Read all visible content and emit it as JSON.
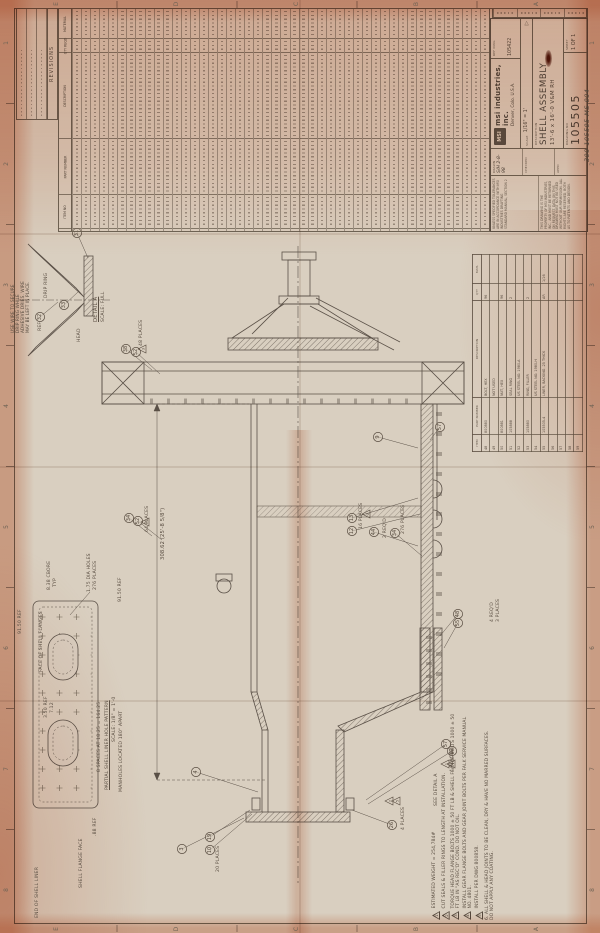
{
  "title_block": {
    "logo": "MSI",
    "company": "msi industries, inc.",
    "company_location": "Denver, Colo. U.S.A.",
    "ref_dwg_label": "REF DWG",
    "ref_dwg": "105422",
    "scale_label": "SCALE",
    "scale": "1/16\" = 1'",
    "description_label": "DESCRIPTION",
    "description_line1": "SHELL ASSEMBLY",
    "description_line2": "13'-6 x 16'-0 V&M RH",
    "drawing_no_label": "DRAWING NO",
    "drawing_no": "105505",
    "sheet_label": "SHEET",
    "sheet": "1 OF 1",
    "drawn_label": "DRAWN",
    "drawn": "S/H 2-8-98",
    "checked_label": "CHECKED",
    "appd_label": "APPD",
    "projection_symbol": "▷",
    "tolerance_note": "UNLESS SPECIFIED TOLERANCES ARE IN ACCORDANCE WITH MSI INDUSTRIES DRAFTING STANDARD MANUAL, SECTION 2",
    "property_note": "THIS DRAWING IS THE PROPERTY OF MSI INDUSTRIES, INC., AND MUST BE RETURNED ON REQUEST. DATA ON THIS DRAWING MUST NOT BE USED WITHOUT OUR PERMISSION. ALL RIGHTS ARE RESERVED, BOTH AS TO PATENTS AND DESIGN."
  },
  "handwritten_number": "300-105505-MS-004",
  "revisions_block": {
    "title": "REVISIONS"
  },
  "parts_table": {
    "headers": [
      "MATERIAL",
      "QTY REQD",
      "DESCRIPTION",
      "PART NUMBER",
      "ITEM NO"
    ],
    "band_heights": [
      30,
      14,
      86,
      56,
      34
    ],
    "column_count": 46
  },
  "mid_parts_table": {
    "headers": [
      "ITEM",
      "PART NUMBER",
      "DESCRIPTION",
      "QTY",
      "MATL"
    ],
    "col_widths": [
      14,
      34,
      94,
      14,
      26
    ],
    "rows": [
      [
        "48",
        "800880",
        "BOLT, HEX",
        "96",
        ""
      ],
      [
        "49",
        "",
        "NOT USED",
        "",
        ""
      ],
      [
        "50",
        "800881",
        "NUT, HEX",
        "96",
        ""
      ],
      [
        "51",
        "105888",
        "SEAL RING",
        "2",
        ""
      ],
      [
        "52",
        "",
        "US STEEL NO. 1980-A",
        "",
        ""
      ],
      [
        "53",
        "105880",
        "RING, FILLER",
        "2",
        ""
      ],
      [
        "54",
        "",
        "US STEEL NO. 1980-H",
        "",
        ""
      ],
      [
        "55",
        "105505-4",
        "LINER, BACKING .25 THICK",
        "AR",
        "1/16"
      ],
      [
        "56",
        "",
        "",
        "",
        ""
      ],
      [
        "57",
        "",
        "",
        "",
        ""
      ],
      [
        "58",
        "",
        "",
        "",
        ""
      ],
      [
        "59",
        "",
        "",
        "",
        ""
      ]
    ]
  },
  "notes": [
    {
      "flag": "1",
      "text": "ESTIMATED WEIGHT = 254,784#"
    },
    {
      "flag": "2",
      "text": "CUT SEALS & FILLER RINGS TO LENGTH AT INSTALLATION."
    },
    {
      "flag": "3",
      "text": "TORQUE HEAD FLANGE BOLTS 1000 ± 50 FT LB & SHELL FLANGE BOLTS 1000 ± 50 FT LB IN \"AS REC'D\" COND. DO NOT OIL."
    },
    {
      "flag": "4",
      "text": "INSTALL GEAR FLANGE BOLTS AND GEAR JOINT BOLTS PER FALK SERVICE MANUAL NO. 4801."
    },
    {
      "flag": "5",
      "text": "INSTALL PER DWG 800858."
    },
    {
      "flag": "",
      "prefix": "6.  ",
      "text": "ALL SHELL & HEAD JOINTS TO BE CLEAN, DRY & HAVE NO MARRED SURFACES. DO NOT APPLY ANY COATING."
    }
  ],
  "drawing_labels": [
    {
      "x": 10,
      "y": 333,
      "t": "USE WIRE TO SECURE",
      "s": 4.2
    },
    {
      "x": 15,
      "y": 333,
      "t": "DRIP RING WHILE",
      "s": 4.2
    },
    {
      "x": 20,
      "y": 333,
      "t": "ADHESIVE DRIES. WIRE",
      "s": 4.2
    },
    {
      "x": 25,
      "y": 333,
      "t": "MAY BE LEFT IN PLACE.",
      "s": 4.2
    },
    {
      "x": 44,
      "y": 298,
      "t": "DRIP RING"
    },
    {
      "x": 38,
      "y": 331,
      "t": "REF"
    },
    {
      "x": 77,
      "y": 342,
      "t": "HEAD"
    },
    {
      "x": 93,
      "y": 322,
      "t": "DETAIL A",
      "s": 5.4,
      "u": true
    },
    {
      "x": 101,
      "y": 322,
      "t": "SCALE: FULL"
    },
    {
      "x": 139,
      "y": 346,
      "t": "48 PLACES"
    },
    {
      "x": 145,
      "y": 532,
      "t": "64 PLACES"
    },
    {
      "x": 160,
      "y": 560,
      "t": "308.62 (25'-8 5/8\")",
      "s": 5.2
    },
    {
      "x": 359,
      "y": 529,
      "t": "16 PLACES"
    },
    {
      "x": 383,
      "y": 538,
      "t": "2 REQ'D"
    },
    {
      "x": 401,
      "y": 534,
      "t": "276 PLACES"
    },
    {
      "x": 18,
      "y": 634,
      "t": "91.50 REF"
    },
    {
      "x": 118,
      "y": 602,
      "t": "91.50 REF"
    },
    {
      "x": 47,
      "y": 590,
      "t": "8.38 CBORE"
    },
    {
      "x": 53,
      "y": 587,
      "t": "TYP"
    },
    {
      "x": 87,
      "y": 592,
      "t": "1.75 DIA HOLES"
    },
    {
      "x": 93,
      "y": 590,
      "t": "276 PLACES"
    },
    {
      "x": 39,
      "y": 672,
      "t": "FACE OF SHELL FLANGES"
    },
    {
      "x": 44,
      "y": 718,
      "t": "3.50 REF"
    },
    {
      "x": 50,
      "y": 713,
      "t": "7.12"
    },
    {
      "x": 97,
      "y": 772,
      "t": "8 SPACES AT 18.25 = 164.25"
    },
    {
      "x": 105,
      "y": 790,
      "t": "PARTIAL SHELL LINER HOLE PATTERN",
      "u": true
    },
    {
      "x": 112,
      "y": 742,
      "t": "SCALE: 1/8\" = 1'-0"
    },
    {
      "x": 119,
      "y": 792,
      "t": "MANHOLES LOCATED 180° APART"
    },
    {
      "x": 93,
      "y": 836,
      "t": ".88 REF"
    },
    {
      "x": 35,
      "y": 918,
      "t": "END OF SHELL LINER"
    },
    {
      "x": 79,
      "y": 888,
      "t": "SHELL FLANGE FACE"
    },
    {
      "x": 434,
      "y": 806,
      "t": "SEE DETAIL A"
    },
    {
      "x": 450,
      "y": 772,
      "t": "4 PLACES"
    },
    {
      "x": 490,
      "y": 622,
      "t": "4 REQ'D"
    },
    {
      "x": 496,
      "y": 622,
      "t": "3 PLACES"
    },
    {
      "x": 216,
      "y": 872,
      "t": "20 PLACES"
    },
    {
      "x": 401,
      "y": 830,
      "t": "4 PLACES"
    },
    {
      "x": 583,
      "y": 162,
      "t": "300-105505-MS-004",
      "s": 6.5,
      "hw": true
    }
  ],
  "balloons": [
    {
      "n": "31",
      "x": 77,
      "y": 233,
      "tx": 88,
      "ty": 258
    },
    {
      "n": "32",
      "x": 40,
      "y": 317,
      "tx": 58,
      "ty": 302
    },
    {
      "n": "33",
      "x": 64,
      "y": 305,
      "tx": 78,
      "ty": 292
    },
    {
      "n": "38",
      "x": 126,
      "y": 349,
      "tx": 152,
      "ty": 370
    },
    {
      "n": "52",
      "x": 136,
      "y": 352,
      "tx": 160,
      "ty": 374
    },
    {
      "n": "34",
      "x": 129,
      "y": 518,
      "tx": 152,
      "ty": 536
    },
    {
      "n": "52",
      "x": 138,
      "y": 521,
      "tx": 162,
      "ty": 540
    },
    {
      "n": "13",
      "x": 352,
      "y": 518,
      "tx": 418,
      "ty": 498
    },
    {
      "n": "12",
      "x": 352,
      "y": 531,
      "tx": 420,
      "ty": 514
    },
    {
      "n": "44",
      "x": 374,
      "y": 532,
      "tx": 418,
      "ty": 546
    },
    {
      "n": "34",
      "x": 395,
      "y": 533,
      "tx": 422,
      "ty": 556
    },
    {
      "n": "9",
      "x": 378,
      "y": 437,
      "tx": 418,
      "ty": 448
    },
    {
      "n": "57",
      "x": 440,
      "y": 427,
      "tx": 430,
      "ty": 440
    },
    {
      "n": "48",
      "x": 458,
      "y": 614,
      "tx": 440,
      "ty": 636
    },
    {
      "n": "55",
      "x": 458,
      "y": 623,
      "tx": 444,
      "ty": 648
    },
    {
      "n": "57",
      "x": 446,
      "y": 744,
      "tx": 366,
      "ty": 800
    },
    {
      "n": "62",
      "x": 452,
      "y": 751,
      "tx": 368,
      "ty": 804
    },
    {
      "n": "4",
      "x": 196,
      "y": 772,
      "tx": 258,
      "ty": 792
    },
    {
      "n": "3",
      "x": 182,
      "y": 849,
      "tx": 244,
      "ty": 818
    },
    {
      "n": "19",
      "x": 210,
      "y": 837,
      "tx": 250,
      "ty": 810
    },
    {
      "n": "10",
      "x": 210,
      "y": 850,
      "tx": 252,
      "ty": 814
    },
    {
      "n": "26",
      "x": 392,
      "y": 825,
      "tx": 352,
      "ty": 810
    }
  ],
  "flags": [
    {
      "n": "3",
      "x": 143,
      "y": 349
    },
    {
      "n": "3",
      "x": 146,
      "y": 522
    },
    {
      "n": "3",
      "x": 367,
      "y": 514
    },
    {
      "n": "2",
      "x": 390,
      "y": 801
    },
    {
      "n": "5",
      "x": 397,
      "y": 801
    },
    {
      "n": "1",
      "x": 446,
      "y": 764
    },
    {
      "n": "4",
      "x": 452,
      "y": 764
    }
  ],
  "zones": {
    "letters": [
      "E",
      "D",
      "C",
      "B",
      "A"
    ],
    "letter_x": [
      57,
      177,
      297,
      417,
      537
    ],
    "numbers": [
      "1",
      "2",
      "3",
      "4",
      "5",
      "6",
      "7",
      "8"
    ],
    "number_y": [
      43,
      164,
      285,
      406,
      527,
      648,
      769,
      890
    ]
  }
}
